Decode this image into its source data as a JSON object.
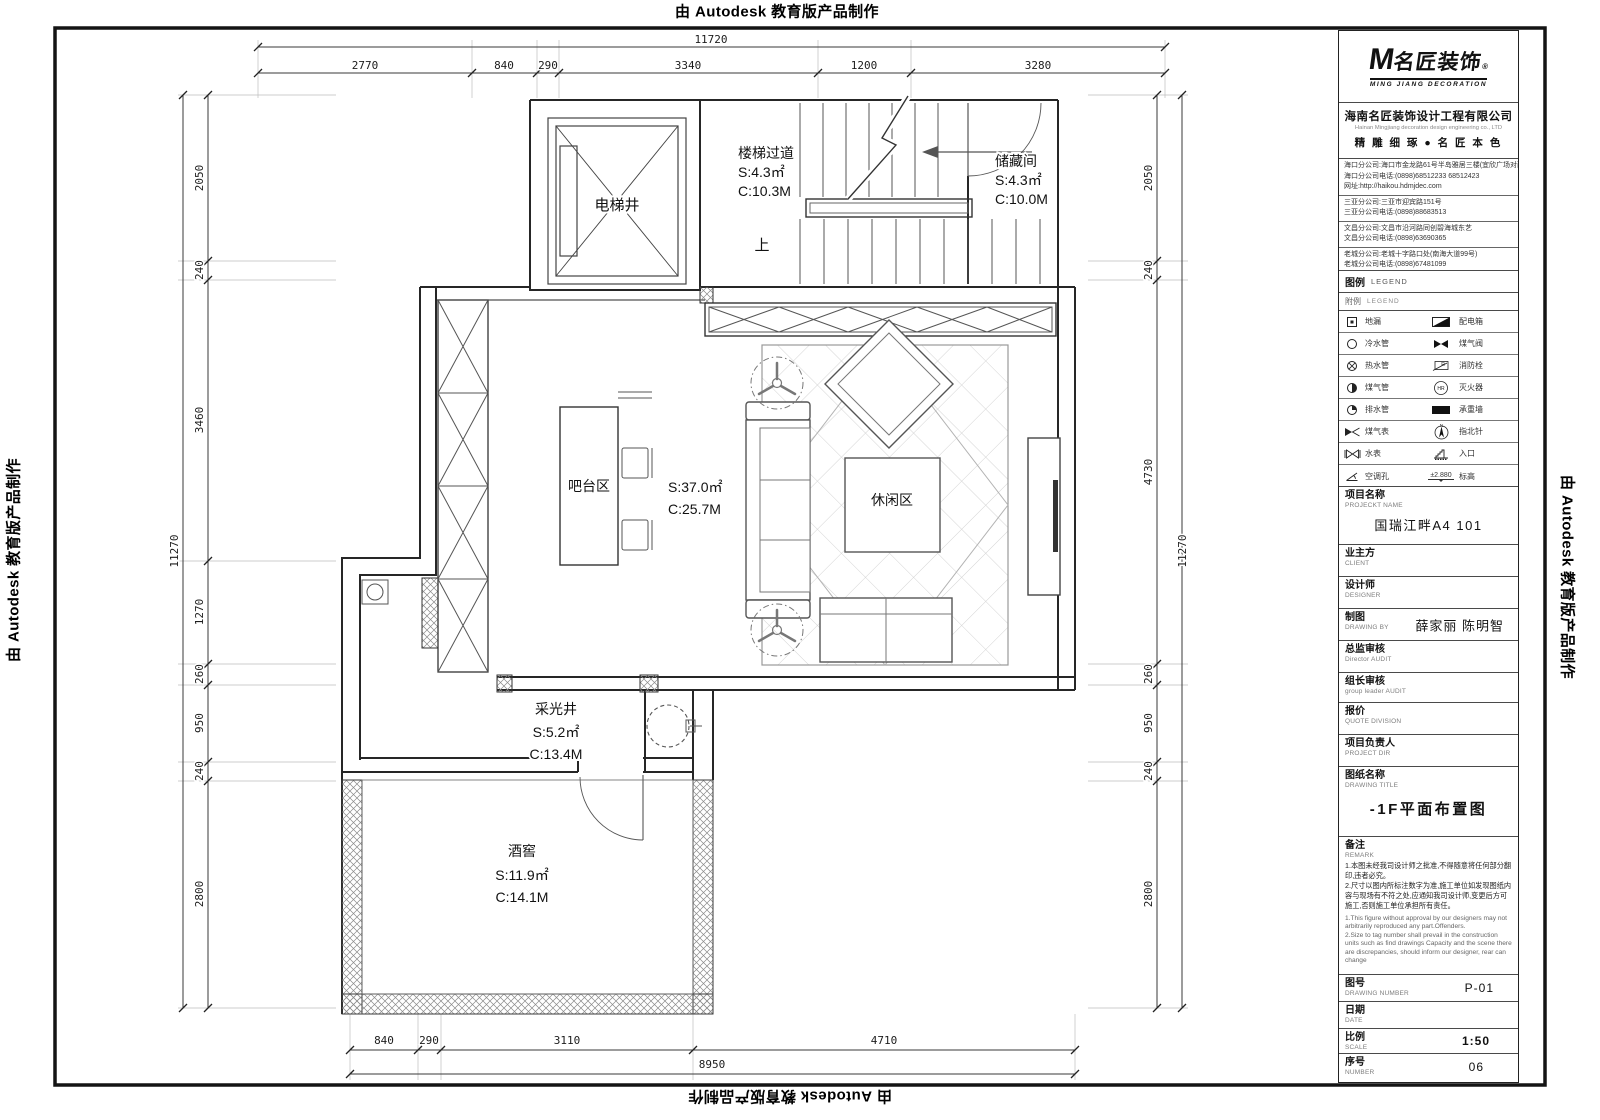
{
  "stamp": {
    "text": "由 Autodesk 教育版产品制作"
  },
  "plan": {
    "rooms": {
      "elevator": {
        "name": "电梯井"
      },
      "stair": {
        "name": "楼梯过道",
        "area": "S:4.3㎡",
        "perimeter": "C:10.3M"
      },
      "storage": {
        "name": "储藏间",
        "area": "S:4.3㎡",
        "perimeter": "C:10.0M"
      },
      "up_label": "上",
      "bar": {
        "name": "吧台区"
      },
      "main": {
        "area": "S:37.0㎡",
        "perimeter": "C:25.7M"
      },
      "leisure": {
        "name": "休闲区"
      },
      "lightwell": {
        "name": "采光井",
        "area": "S:5.2㎡",
        "perimeter": "C:13.4M"
      },
      "cellar": {
        "name": "酒窖",
        "area": "S:11.9㎡",
        "perimeter": "C:14.1M"
      }
    },
    "dims": {
      "top_overall": "11720",
      "top_segments": [
        "2770",
        "840",
        "290",
        "3340",
        "1200",
        "3280"
      ],
      "left_overall": "11270",
      "left_segments": [
        "2050",
        "240",
        "3460",
        "1270",
        "260",
        "950",
        "240",
        "2800"
      ],
      "right_overall": "11270",
      "right_segments": [
        "2050",
        "240",
        "4730",
        "260",
        "950",
        "240",
        "2800"
      ],
      "bottom_overall": "8950",
      "bottom_segments": [
        "840",
        "290",
        "3110",
        "4710"
      ]
    }
  },
  "titleblock": {
    "logo": {
      "m": "M",
      "brand": "名匠装饰",
      "reg": "®",
      "sub": "MING JIANG DECORATION"
    },
    "company": {
      "name": "海南名匠装饰设计工程有限公司",
      "name_en": "Hainan Mingjiang decoration design engineering co., LTD",
      "slogan": "精 雕 细 琢 ● 名 匠 本 色"
    },
    "branches": [
      {
        "lines": [
          "海口分公司:海口市金龙路61号半岛雅居三楼(宜欣广场对面)",
          "海口分公司电话:(0898)68512233 68512423",
          "网址:http://haikou.hdmjdec.com"
        ]
      },
      {
        "lines": [
          "三亚分公司:三亚市迎宾路151号",
          "三亚分公司电话:(0898)88683513"
        ]
      },
      {
        "lines": [
          "文昌分公司:文昌市沿河路同创碧海城东艺",
          "文昌分公司电话:(0898)63690365"
        ]
      },
      {
        "lines": [
          "老城分公司:老城十字路口处(南海大道99号)",
          "老城分公司电话:(0898)67481099"
        ]
      }
    ],
    "legend": {
      "title_zh": "图例",
      "title_en": "LEGEND",
      "subtitle_zh": "附例",
      "subtitle_en": "LEGEND",
      "rows": [
        {
          "left": "地漏",
          "right": "配电箱"
        },
        {
          "left": "冷水管",
          "right": "煤气阀"
        },
        {
          "left": "热水管",
          "right": "消防栓"
        },
        {
          "left": "煤气管",
          "right": "灭火器"
        },
        {
          "left": "排水管",
          "right": "承重墙"
        },
        {
          "left": "煤气表",
          "right": "指北针"
        },
        {
          "left": "水表",
          "right": "入口"
        },
        {
          "left": "空调孔",
          "right": "标高"
        }
      ],
      "north_letter": "N",
      "hr_label": "HR",
      "r_label": "R",
      "elevation": "±2.880"
    },
    "fields": {
      "project": {
        "zh": "项目名称",
        "en": "PROJECKT NAME",
        "value": "国瑞江畔A4 101"
      },
      "client": {
        "zh": "业主方",
        "en": "CLIENT"
      },
      "designer": {
        "zh": "设计师",
        "en": "DESIGNER"
      },
      "drawing_by": {
        "zh": "制图",
        "en": "DRAWING BY",
        "value": "薛家丽 陈明智"
      },
      "director_audit": {
        "zh": "总监审核",
        "en": "Director AUDIT"
      },
      "leader_audit": {
        "zh": "组长审核",
        "en": "group leader AUDIT"
      },
      "quote": {
        "zh": "报价",
        "en": "QUOTE DIVISION"
      },
      "project_dir": {
        "zh": "项目负责人",
        "en": "PROJECT DIR"
      },
      "drawing_title": {
        "zh": "图纸名称",
        "en": "DRAWING TITLE",
        "value": "-1F平面布置图"
      },
      "remark": {
        "zh": "备注",
        "en": "REMARK",
        "notes_zh": [
          "1.本图未经我司设计师之批准,不得随意将任何部分翻印,违者必究。",
          "2.尺寸以图内所标注数字为准,施工单位如发现图纸内容与现场有不符之处,应通知我司设计师,变更后方可施工,否则施工单位承担所有责任。"
        ],
        "notes_en": [
          "1.This figure without approval by our designers may not arbitrarily reproduced any part.Offenders.",
          "2.Size to tag number shall prevail in the construction units such as find drawings Capacity and the scene there are discrepancies, should inform our designer, rear can change"
        ]
      },
      "drawing_number": {
        "zh": "图号",
        "en": "DRAWING NUMBER",
        "value": "P-01"
      },
      "date": {
        "zh": "日期",
        "en": "DATE"
      },
      "scale": {
        "zh": "比例",
        "en": "SCALE",
        "value": "1:50"
      },
      "number": {
        "zh": "序号",
        "en": "NUMBER",
        "value": "06"
      }
    }
  }
}
